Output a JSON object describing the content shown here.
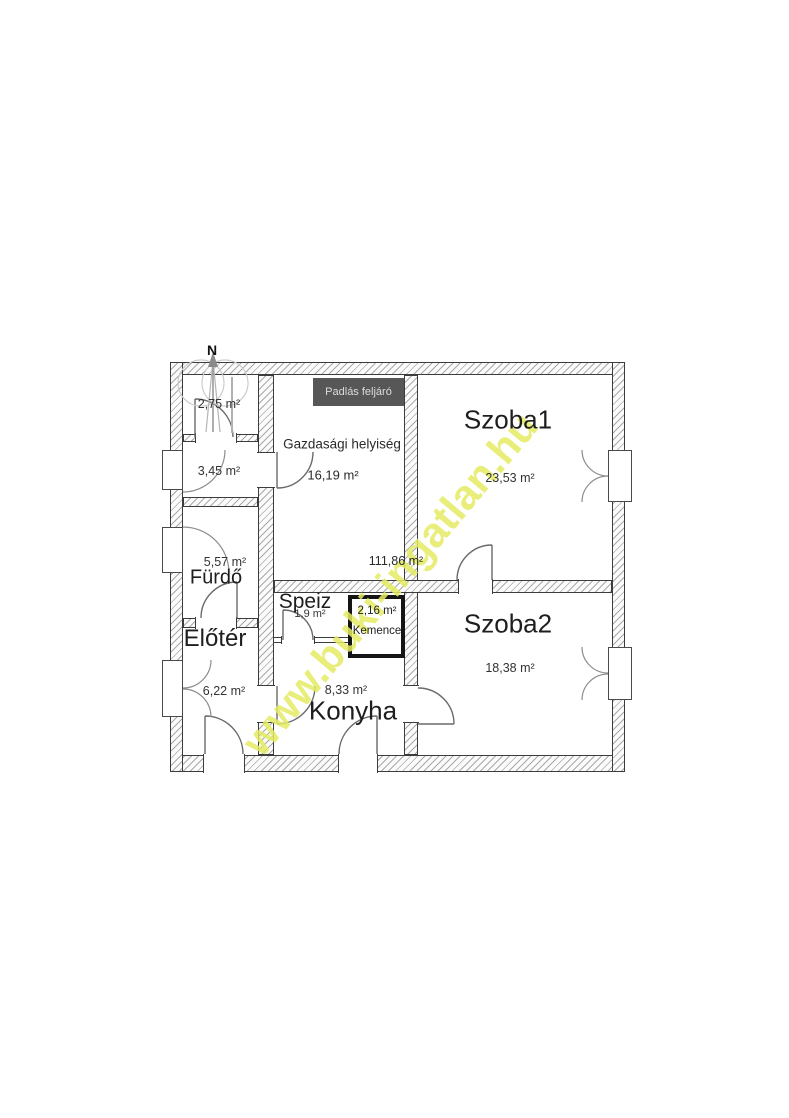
{
  "watermark": {
    "text": "www.buki-ingatlan.hu",
    "color": "#e4ec62"
  },
  "compass": {
    "label": "N"
  },
  "total_area": "111,86 m²",
  "attic_access": {
    "label": "Padlás feljáró"
  },
  "rooms": {
    "wc": {
      "area": "2,75 m²"
    },
    "storage": {
      "area": "3,45 m²"
    },
    "bathroom": {
      "name": "Fürdő",
      "area": "5,57 m²"
    },
    "entry_hall": {
      "name": "Előtér",
      "area": "6,22 m²"
    },
    "pantry": {
      "name": "Speiz",
      "area": "1,9 m²"
    },
    "oven": {
      "name": "Kemence",
      "area": "2,16 m²"
    },
    "kitchen": {
      "name": "Konyha",
      "area": "8,33 m²"
    },
    "utility_room": {
      "name": "Gazdasági helyiség",
      "area": "16,19 m²"
    },
    "room1": {
      "name": "Szoba1",
      "area": "23,53 m²"
    },
    "room2": {
      "name": "Szoba2",
      "area": "18,38 m²"
    }
  }
}
